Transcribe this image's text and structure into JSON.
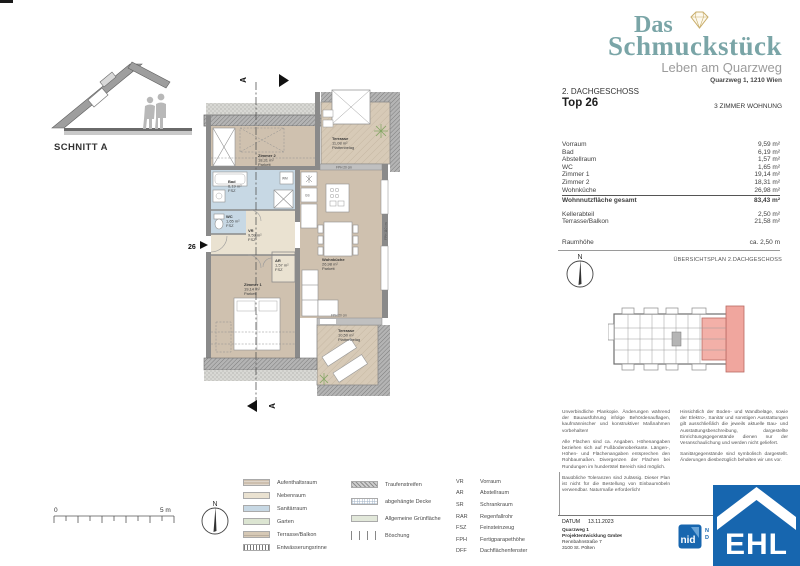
{
  "header": {
    "brand_line1": "Das",
    "brand_line2": "Schmuckstück",
    "subtitle": "Leben am Quarzweg",
    "address": "Quarzweg 1, 1210 Wien",
    "floor": "2. DACHGESCHOSS",
    "unit": "Top 26",
    "unit_type": "3 ZIMMER WOHNUNG"
  },
  "area_table": {
    "rows": [
      {
        "label": "Vorraum",
        "value": "9,59 m²"
      },
      {
        "label": "Bad",
        "value": "6,19 m²"
      },
      {
        "label": "Abstellraum",
        "value": "1,57 m²"
      },
      {
        "label": "WC",
        "value": "1,65 m²"
      },
      {
        "label": "Zimmer 1",
        "value": "19,14 m²"
      },
      {
        "label": "Zimmer 2",
        "value": "18,31 m²"
      },
      {
        "label": "Wohnküche",
        "value": "26,98 m²"
      }
    ],
    "total": {
      "label": "Wohnnutzfläche gesamt",
      "value": "83,43 m²"
    },
    "extra": [
      {
        "label": "Kellerabteil",
        "value": "2,50 m²"
      },
      {
        "label": "Terrasse/Balkon",
        "value": "21,58 m²"
      }
    ],
    "room_height": {
      "label": "Raumhöhe",
      "value": "ca. 2,50 m"
    }
  },
  "overview": {
    "title": "ÜBERSICHTSPLAN 2.DACHGESCHOSS"
  },
  "compass_n": "N",
  "section": {
    "label": "SCHNITT A",
    "marker": "A"
  },
  "plan": {
    "unit_number": "26",
    "rooms": [
      {
        "name": "Zimmer 2",
        "area": "18,31 m²",
        "floor": "Parkett"
      },
      {
        "name": "Terrasse",
        "area": "11,08 m²",
        "floor": "Plattenbelag"
      },
      {
        "name": "Bad",
        "area": "6,19 m²",
        "floor": "FSZ"
      },
      {
        "name": "WC",
        "area": "1,65 m²",
        "floor": "FSZ"
      },
      {
        "name": "VR",
        "area": "9,59 m²",
        "floor": "FSZ"
      },
      {
        "name": "AR",
        "area": "1,57 m²",
        "floor": "FSZ"
      },
      {
        "name": "Zimmer 1",
        "area": "19,14 m²",
        "floor": "Parkett"
      },
      {
        "name": "Wohnküche",
        "area": "26,98 m²",
        "floor": "Parkett"
      },
      {
        "name": "Terrasse",
        "area": "10,50 m²",
        "floor": "Plattenbelag"
      }
    ],
    "annotations": {
      "wm": "WM",
      "gs": "GS",
      "fph_top": "FPH 20 cm",
      "fph_bottom": "FPH 20 cm",
      "fph_side": "FPH 110 cm"
    }
  },
  "scalebar": {
    "zero": "0",
    "five": "5 m"
  },
  "legend": {
    "swatches": [
      {
        "label": "Aufenthaltsraum"
      },
      {
        "label": "Nebenraum"
      },
      {
        "label": "Sanitärraum"
      },
      {
        "label": "Garten"
      },
      {
        "label": "Terrasse/Balkon"
      },
      {
        "label": "Entwässerungsrinne"
      }
    ],
    "patterns": [
      {
        "label": "Traufenstreifen"
      },
      {
        "label": "abgehängte Decke"
      },
      {
        "label": "Allgemeine Grünfläche"
      },
      {
        "label": "Böschung"
      }
    ],
    "abbreviations": [
      {
        "abbr": "VR",
        "label": "Vorraum"
      },
      {
        "abbr": "AR",
        "label": "Abstellraum"
      },
      {
        "abbr": "SR",
        "label": "Schrankraum"
      },
      {
        "abbr": "RAR",
        "label": "Regenfallrohr"
      },
      {
        "abbr": "FSZ",
        "label": "Feinsteinzeug"
      },
      {
        "abbr": "FPH",
        "label": "Fertigparapethöhe"
      },
      {
        "abbr": "DFF",
        "label": "Dachflächenfenster"
      }
    ]
  },
  "disclaimer": {
    "left": [
      "Unverbindliche Plankopie. Änderungen während der Bauausführung infolge Behördenauflagen, kaufmännischer und konstruktiver Maßnahmen vorbehalten!",
      "Alle Flächen sind ca. Angaben. Höhenangaben beziehen sich auf Fußbodenoberkante. Längen-, Höhen- und Flächenangaben entsprechen den Rohbaumaßen. Divergenzen der Flächen bei Rundungen im hundertstel Bereich sind möglich.",
      "Bauübliche Toleranzen sind zulässig. Dieser Plan ist nicht für die Bestellung von Einbaumöbeln verwendbar. Naturmaße erforderlich!"
    ],
    "right": [
      "Hinsichtlich der Boden- und Wandbeläge, sowie der Elektro-, Sanitär und sonstigen Ausstattungen gilt ausschließlich die jeweils aktuelle Bau- und Ausstattungsbeschreibung, dargestellte Einrichtungsgegenstände dienen nur der Veranschaulichung und werden nicht geliefert.",
      "Sanitärgegenstände sind symbolisch dargestellt. Änderungen diesbezüglich behalten wir uns vor."
    ]
  },
  "footer": {
    "date_label": "DATUM",
    "date": "13.11.2023",
    "company_line1": "Quarzweg 1",
    "company_line2": "Projektentwicklung GmbH",
    "company_line3": "Rennbahnstraße 7",
    "company_line4": "3100 St. Pölten",
    "nid_logo_text": "nid",
    "partner_fragment1": "N",
    "partner_fragment2": "D",
    "ehl_logo_text": "EHL"
  },
  "colors": {
    "brand_teal": "#7aa5a7",
    "diamond_gold": "#c9ae6b",
    "room_tan": "#cfc1af",
    "room_beige": "#eae2d1",
    "room_blue": "#c7d8e4",
    "terrace_tan": "#d7cab7",
    "highlight_pink": "#f3b0a8",
    "logo_blue": "#1766af"
  }
}
